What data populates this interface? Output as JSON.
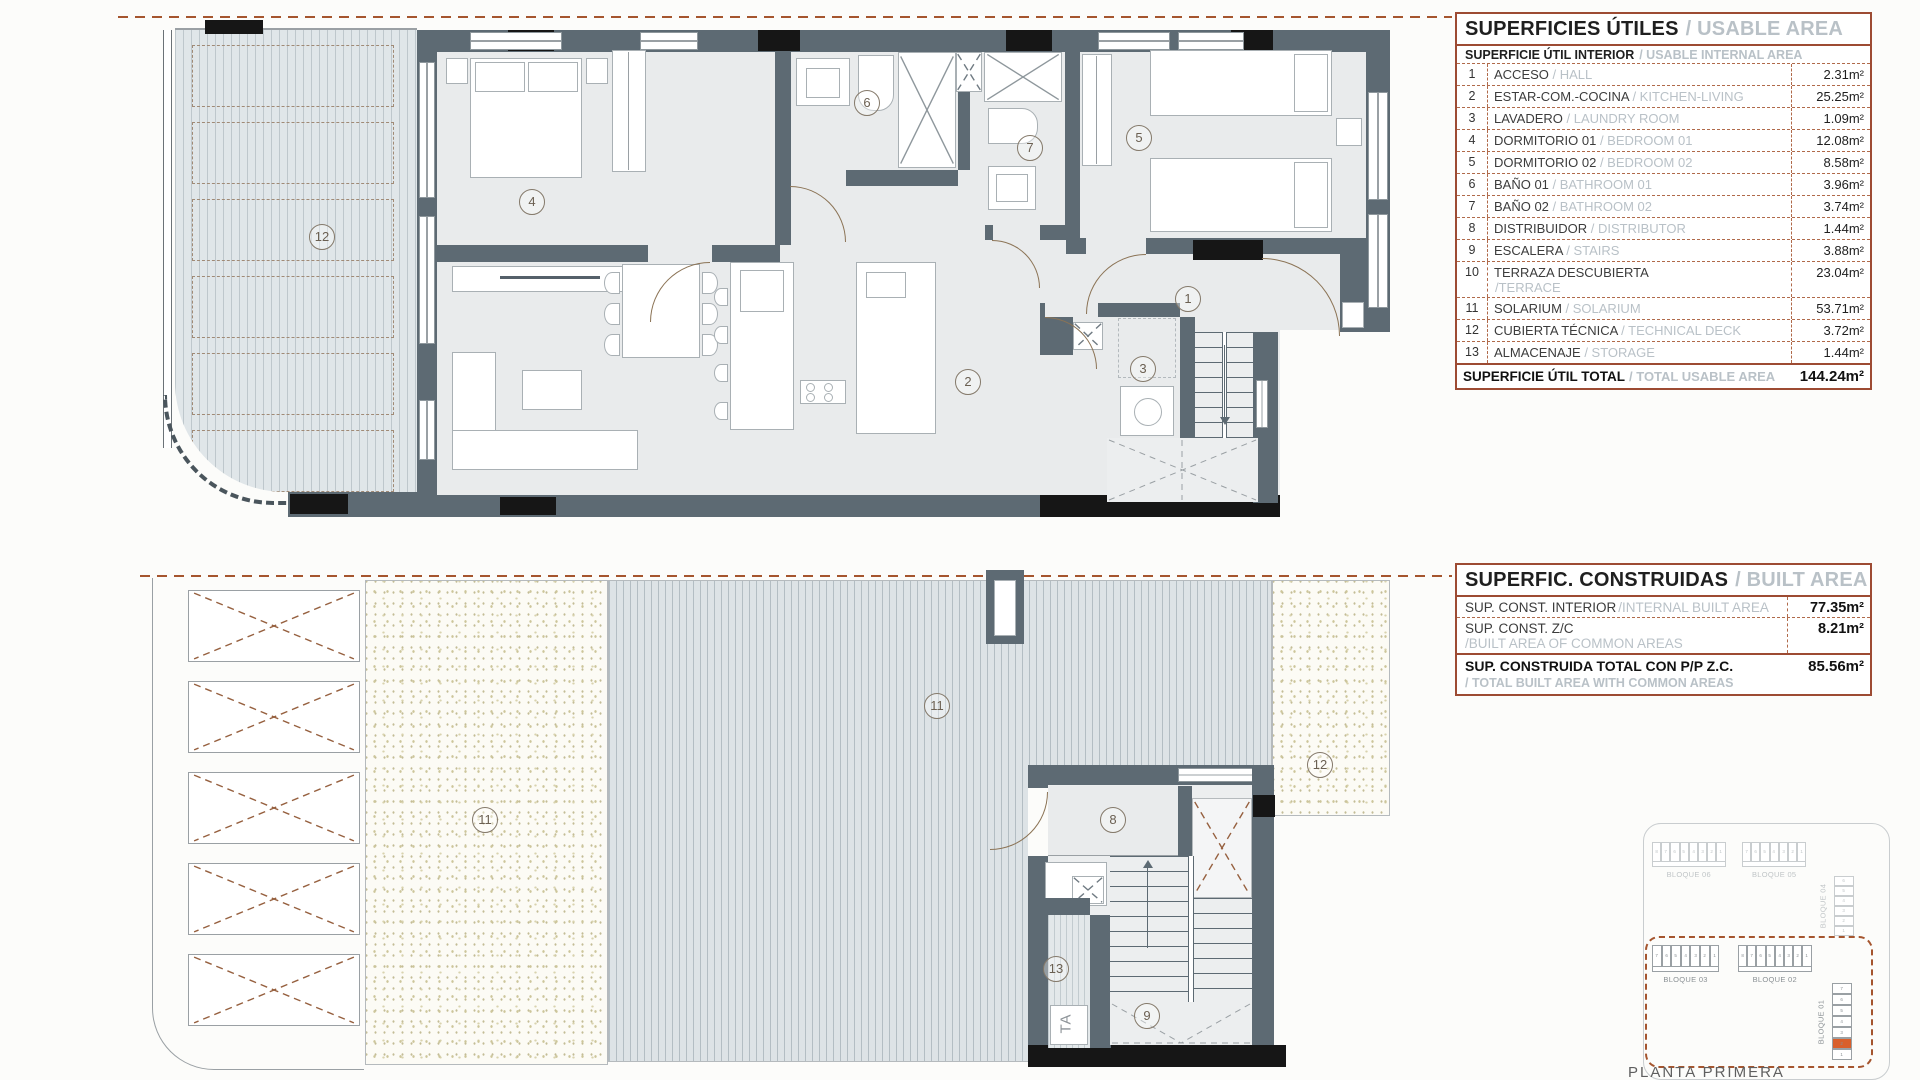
{
  "usable_area_table": {
    "title_es": "SUPERFICIES ÚTILES",
    "title_en": "/ USABLE AREA",
    "subtitle_es": "SUPERFICIE ÚTIL INTERIOR",
    "subtitle_en": "/ USABLE INTERNAL AREA",
    "rows": [
      {
        "num": "1",
        "es": "ACCESO",
        "en": "/ HALL",
        "value": "2.31m²"
      },
      {
        "num": "2",
        "es": "ESTAR-COM.-COCINA",
        "en": "/ KITCHEN-LIVING",
        "value": "25.25m²"
      },
      {
        "num": "3",
        "es": "LAVADERO",
        "en": "/ LAUNDRY ROOM",
        "value": "1.09m²"
      },
      {
        "num": "4",
        "es": "DORMITORIO 01",
        "en": "/ BEDROOM 01",
        "value": "12.08m²"
      },
      {
        "num": "5",
        "es": "DORMITORIO 02",
        "en": "/ BEDROOM 02",
        "value": "8.58m²"
      },
      {
        "num": "6",
        "es": "BAÑO 01",
        "en": "/ BATHROOM 01",
        "value": "3.96m²"
      },
      {
        "num": "7",
        "es": "BAÑO 02",
        "en": "/ BATHROOM 02",
        "value": "3.74m²"
      },
      {
        "num": "8",
        "es": "DISTRIBUIDOR",
        "en": "/ DISTRIBUTOR",
        "value": "1.44m²"
      },
      {
        "num": "9",
        "es": "ESCALERA",
        "en": "/ STAIRS",
        "value": "3.88m²"
      },
      {
        "num": "10",
        "es": "TERRAZA DESCUBIERTA",
        "en": "/TERRACE",
        "value": "23.04m²"
      },
      {
        "num": "11",
        "es": "SOLARIUM",
        "en": "/ SOLARIUM",
        "value": "53.71m²"
      },
      {
        "num": "12",
        "es": "CUBIERTA TÉCNICA",
        "en": "/ TECHNICAL DECK",
        "value": "3.72m²"
      },
      {
        "num": "13",
        "es": "ALMACENAJE",
        "en": "/ STORAGE",
        "value": "1.44m²"
      }
    ],
    "total": {
      "es": "SUPERFICIE ÚTIL TOTAL",
      "en": "/ TOTAL USABLE AREA",
      "value": "144.24m²"
    }
  },
  "built_area_table": {
    "title_es": "SUPERFIC. CONSTRUIDAS",
    "title_en": "/ BUILT AREA",
    "rows": [
      {
        "es": "SUP. CONST. INTERIOR",
        "en": "/INTERNAL BUILT AREA",
        "value": "77.35m²"
      },
      {
        "es": "SUP. CONST. Z/C",
        "en": "/BUILT AREA OF COMMON AREAS",
        "value": "8.21m²"
      }
    ],
    "total": {
      "es": "SUP. CONSTRUIDA TOTAL CON P/P Z.C.",
      "en": "/ TOTAL BUILT AREA WITH COMMON AREAS",
      "value": "85.56m²"
    }
  },
  "upper_plan": {
    "labels": {
      "terrace": "12",
      "bedroom1": "4",
      "bathroom1": "6",
      "bathroom2": "7",
      "bedroom2": "5",
      "hall": "1",
      "laundry": "3",
      "living": "2"
    }
  },
  "lower_plan": {
    "labels": {
      "solarium_main": "11",
      "solarium_deck": "11",
      "distributor": "8",
      "stairs": "9",
      "storage": "13",
      "technical_deck": "12"
    },
    "storage_text": "TA"
  },
  "key_plan": {
    "caption": "PLANTA PRIMERA",
    "context_blocks": [
      {
        "label": "BLOQUE 06",
        "units": [
          "8",
          "7",
          "6",
          "5",
          "4",
          "3",
          "2",
          "1"
        ]
      },
      {
        "label": "BLOQUE 05",
        "units": [
          "7",
          "6",
          "5",
          "4",
          "3",
          "2",
          "1"
        ]
      },
      {
        "label": "BLOQUE 04",
        "units": [
          "6",
          "5",
          "4",
          "3",
          "2",
          "1"
        ]
      }
    ],
    "selected_blocks": [
      {
        "label": "BLOQUE 03",
        "units": [
          "7",
          "6",
          "5",
          "4",
          "3",
          "2",
          "1"
        ]
      },
      {
        "label": "BLOQUE 02",
        "units": [
          "8",
          "7",
          "6",
          "5",
          "4",
          "3",
          "2",
          "1"
        ]
      },
      {
        "label": "BLOQUE 01",
        "units": [
          "7",
          "6",
          "5",
          "4",
          "3",
          "2",
          "1"
        ],
        "highlighted_unit": "2"
      }
    ]
  },
  "colors": {
    "accent_brown": "#9d4b33",
    "highlight_orange": "#d95f2b",
    "wall_gray": "#5d6a73",
    "text_gray_en": "#b9c1c7"
  }
}
